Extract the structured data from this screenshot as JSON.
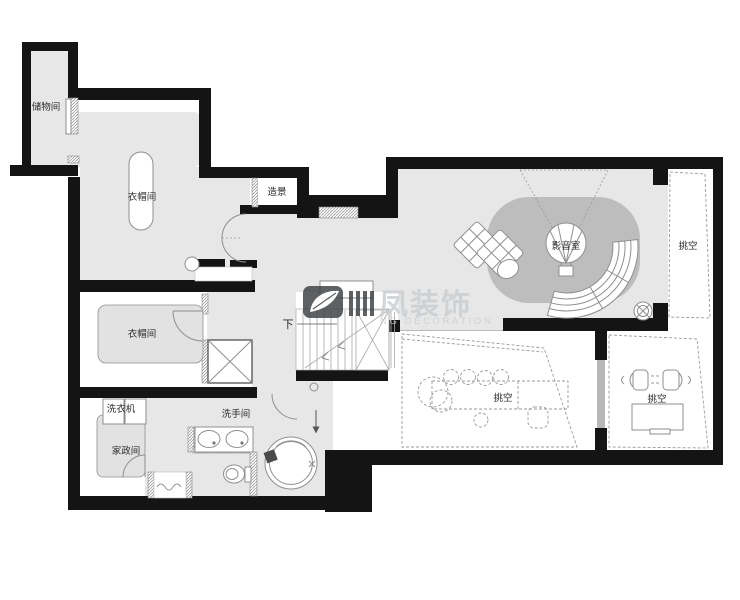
{
  "plan": {
    "labels": {
      "storage": "储物间",
      "cloak_upper": "衣帽间",
      "landscape": "造景",
      "media": "影音室",
      "void_right": "挑空",
      "down": "下",
      "cloak_lower": "衣帽间",
      "washer": "洗衣机",
      "washroom": "洗手间",
      "housekeeping": "家政间",
      "void_bottom_left": "挑空",
      "void_bottom_right": "挑空"
    },
    "watermark": {
      "brand": "凤装饰",
      "tagline": "NG DECORATION"
    },
    "colors": {
      "wall": "#141414",
      "floor": "#e7e7e7",
      "rug": "#bdbdbd",
      "rug-light": "#e2e2e2",
      "line": "#8f8f8f",
      "label": "#2b2b2b",
      "watermark": "#c9ced2",
      "logo": "#3b3f42"
    }
  }
}
